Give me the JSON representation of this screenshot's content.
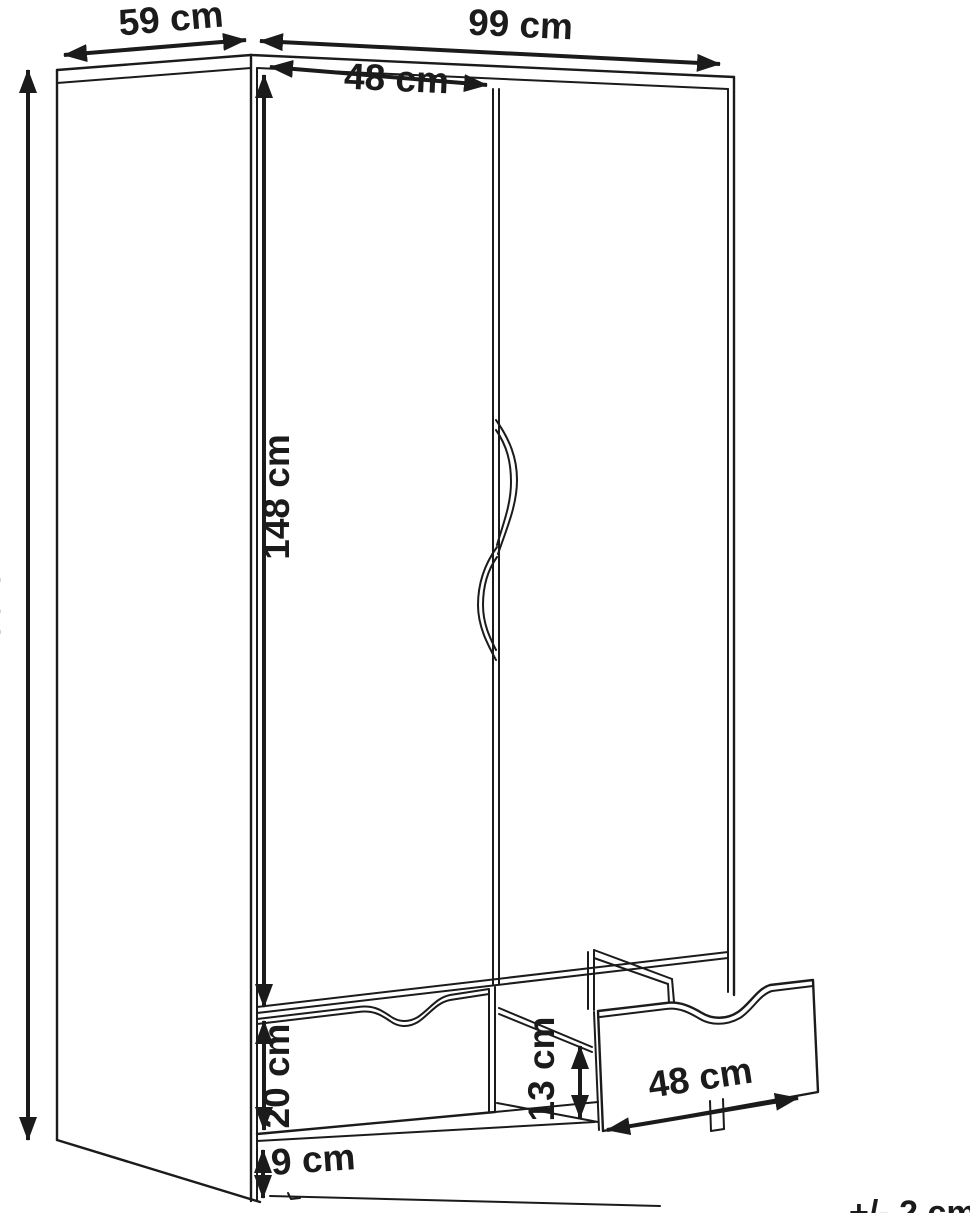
{
  "diagram": {
    "subject": "wardrobe-dimension-drawing",
    "labels": {
      "depth": "59 cm",
      "width": "99 cm",
      "door_width": "48 cm",
      "total_height": "180 cm",
      "door_height": "148 cm",
      "drawer_front_height": "20 cm",
      "base_height": "9 cm",
      "drawer_inner_height": "13 cm",
      "drawer_width": "48 cm",
      "tolerance_note": "+/- 2 cm"
    },
    "colors": {
      "line": "#1b1b1b",
      "background": "#ffffff"
    }
  }
}
